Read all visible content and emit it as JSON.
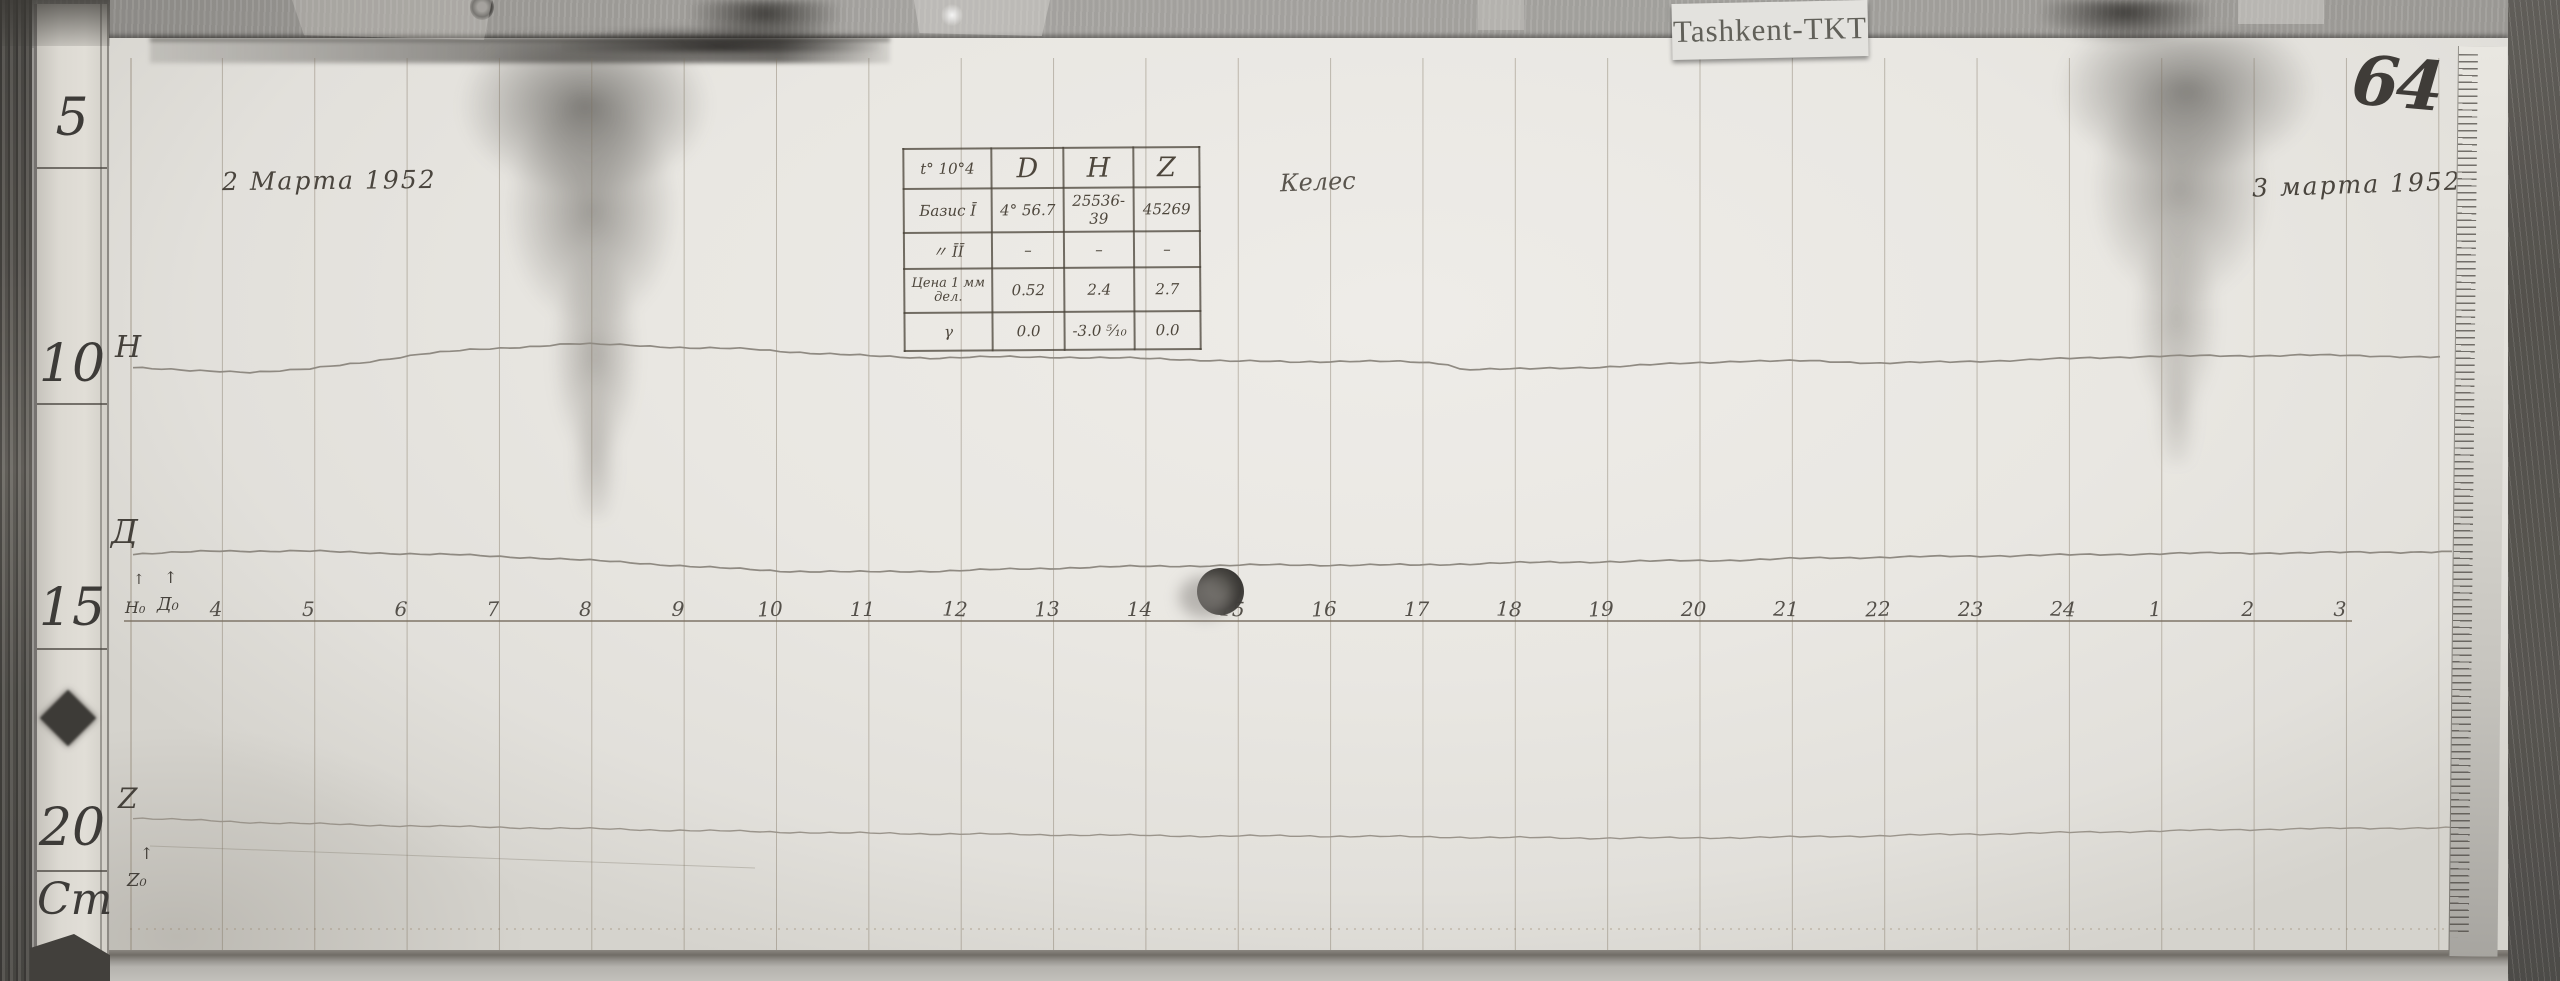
{
  "station_card": {
    "label": "Tashkent-TKT"
  },
  "page_number": "64",
  "annotations": {
    "date_left": "2 Марта 1952",
    "date_right": "3 марта 1952",
    "station_name": "Келес"
  },
  "left_ruler": {
    "marks": [
      "5",
      "10",
      "15",
      "20",
      "Cm"
    ]
  },
  "hours": [
    "4",
    "5",
    "6",
    "7",
    "8",
    "9",
    "10",
    "11",
    "12",
    "13",
    "14",
    "15",
    "16",
    "17",
    "18",
    "19",
    "20",
    "21",
    "22",
    "23",
    "24",
    "1",
    "2",
    "3"
  ],
  "table": {
    "col_header": [
      "t° 10°4",
      "D",
      "H",
      "Z"
    ],
    "rows": [
      [
        "Базис Ī",
        "4° 56.7",
        "25536-39",
        "45269"
      ],
      [
        "〃  ĪĪ",
        "–",
        "–",
        "–"
      ],
      [
        "Цена 1 мм дел.",
        "0.52",
        "2.4",
        "2.7"
      ],
      [
        "γ",
        "0.0",
        "-3.0 ⁵⁄₁₀",
        "0.0"
      ]
    ]
  },
  "traces": {
    "h_label": "Н",
    "d_label": "Д",
    "z_label": "Z",
    "h_base_label": "Н₀",
    "d_base_label": "Д₀",
    "z_base_label": "Z₀",
    "arrow": "↑",
    "h_points": [
      [
        133,
        367
      ],
      [
        190,
        371
      ],
      [
        250,
        372
      ],
      [
        310,
        369
      ],
      [
        360,
        363
      ],
      [
        420,
        354
      ],
      [
        470,
        350
      ],
      [
        520,
        347
      ],
      [
        570,
        344
      ],
      [
        630,
        345
      ],
      [
        690,
        348
      ],
      [
        750,
        349
      ],
      [
        810,
        353
      ],
      [
        870,
        356
      ],
      [
        930,
        358
      ],
      [
        990,
        357
      ],
      [
        1050,
        357
      ],
      [
        1110,
        358
      ],
      [
        1170,
        359
      ],
      [
        1230,
        361
      ],
      [
        1290,
        362
      ],
      [
        1350,
        361
      ],
      [
        1410,
        362
      ],
      [
        1448,
        364
      ],
      [
        1460,
        369
      ],
      [
        1530,
        369
      ],
      [
        1600,
        367
      ],
      [
        1670,
        364
      ],
      [
        1740,
        361
      ],
      [
        1810,
        361
      ],
      [
        1880,
        363
      ],
      [
        1950,
        362
      ],
      [
        2020,
        360
      ],
      [
        2090,
        358
      ],
      [
        2160,
        356
      ],
      [
        2230,
        356
      ],
      [
        2300,
        355
      ],
      [
        2370,
        356
      ],
      [
        2440,
        357
      ]
    ],
    "d_points": [
      [
        133,
        554
      ],
      [
        220,
        551
      ],
      [
        300,
        551
      ],
      [
        380,
        553
      ],
      [
        460,
        555
      ],
      [
        540,
        558
      ],
      [
        620,
        562
      ],
      [
        700,
        567
      ],
      [
        780,
        571
      ],
      [
        860,
        572
      ],
      [
        940,
        571
      ],
      [
        1020,
        569
      ],
      [
        1100,
        567
      ],
      [
        1180,
        566
      ],
      [
        1260,
        565
      ],
      [
        1340,
        565
      ],
      [
        1420,
        565
      ],
      [
        1500,
        563
      ],
      [
        1580,
        562
      ],
      [
        1660,
        561
      ],
      [
        1740,
        560
      ],
      [
        1820,
        558
      ],
      [
        1900,
        557
      ],
      [
        1980,
        556
      ],
      [
        2060,
        555
      ],
      [
        2140,
        554
      ],
      [
        2220,
        553
      ],
      [
        2300,
        553
      ],
      [
        2380,
        552
      ],
      [
        2452,
        552
      ]
    ],
    "z_points": [
      [
        133,
        818
      ],
      [
        240,
        822
      ],
      [
        360,
        825
      ],
      [
        480,
        827
      ],
      [
        600,
        829
      ],
      [
        720,
        831
      ],
      [
        840,
        833
      ],
      [
        960,
        834
      ],
      [
        1080,
        835
      ],
      [
        1200,
        836
      ],
      [
        1320,
        836
      ],
      [
        1440,
        837
      ],
      [
        1560,
        838
      ],
      [
        1680,
        838
      ],
      [
        1800,
        837
      ],
      [
        1920,
        835
      ],
      [
        2040,
        833
      ],
      [
        2160,
        831
      ],
      [
        2280,
        829
      ],
      [
        2400,
        828
      ],
      [
        2455,
        828
      ]
    ]
  },
  "colors": {
    "paper": "#e9e7e2",
    "grid_line": "#82765f",
    "trace_ink": "#8f8a82",
    "handwriting_ink": "#4a453e",
    "wood": "#57544f",
    "baseline": "#8d8478"
  }
}
